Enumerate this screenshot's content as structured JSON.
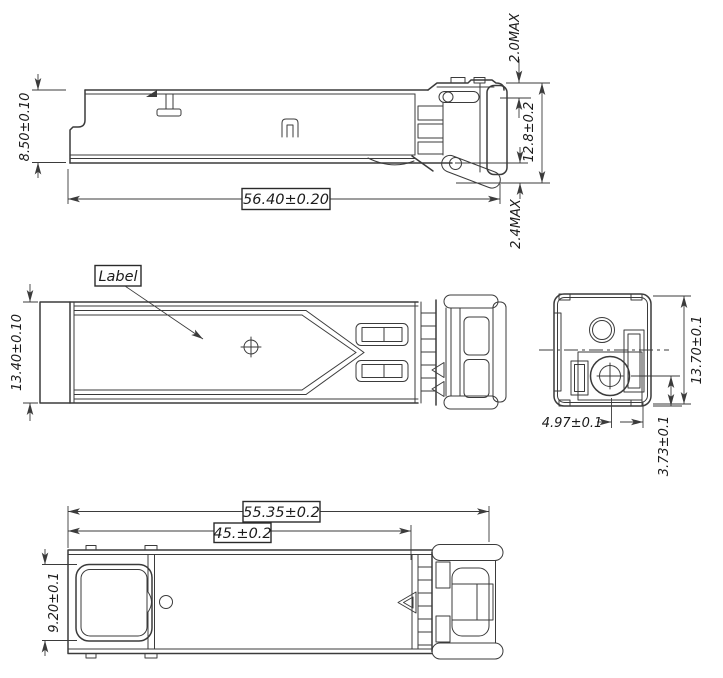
{
  "drawing": {
    "background_color": "#ffffff",
    "line_color": "#3b3b3b",
    "views": {
      "side": {
        "dim_body_height": "8.50±0.10",
        "dim_body_length": "56.40±0.20",
        "dim_latch_height_max": "2.0MAX",
        "dim_overall_height": "12.8±0.2",
        "dim_bail_drop_max": "2.4MAX"
      },
      "top": {
        "dim_body_width": "13.40±0.10",
        "label_callout": "Label"
      },
      "front": {
        "dim_overall_height": "13.70±0.1",
        "dim_ferrule_center_x": "4.97±0.1",
        "dim_ferrule_center_y": "3.73±0.1"
      },
      "bottom": {
        "dim_overall_length": "55.35±0.2",
        "dim_body_length": "45.±0.2",
        "dim_opening_width": "9.20±0.1"
      }
    }
  }
}
